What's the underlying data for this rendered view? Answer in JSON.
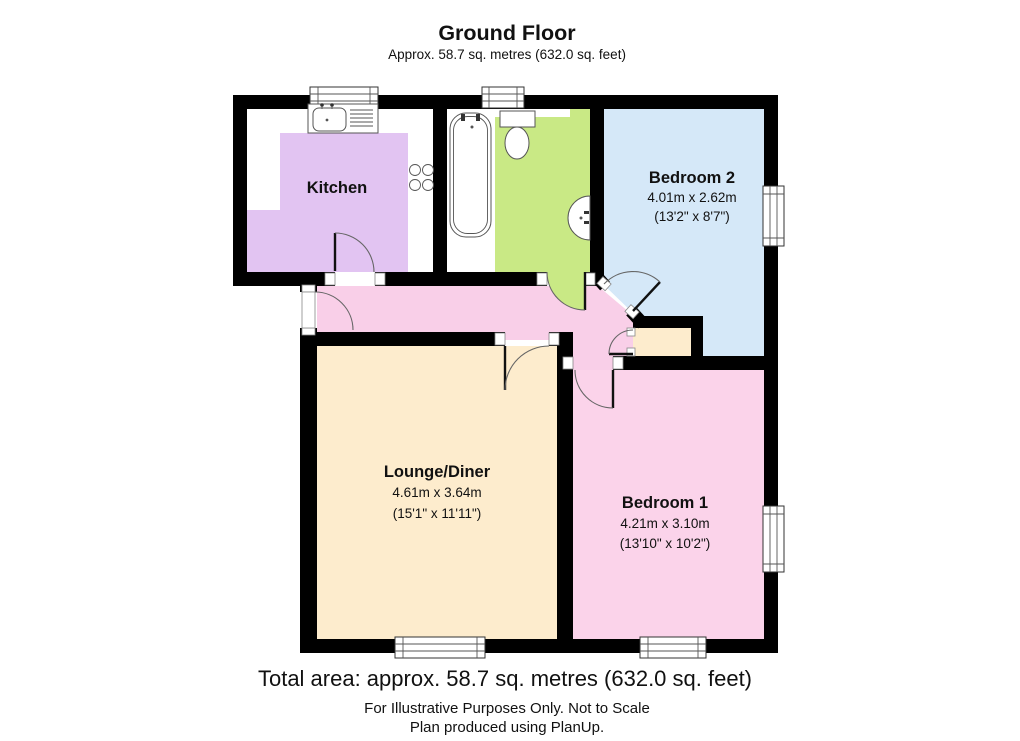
{
  "header": {
    "title": "Ground Floor",
    "subtitle": "Approx.  58.7 sq. metres (632.0 sq. feet)"
  },
  "rooms": {
    "kitchen": {
      "name": "Kitchen"
    },
    "bedroom2": {
      "name": "Bedroom 2",
      "metric": "4.01m x 2.62m",
      "imperial": "(13'2\" x 8'7\")"
    },
    "lounge": {
      "name": "Lounge/Diner",
      "metric": "4.61m x 3.64m",
      "imperial": "(15'1\" x 11'11\")"
    },
    "bedroom1": {
      "name": "Bedroom 1",
      "metric": "4.21m x 3.10m",
      "imperial": "(13'10\" x 10'2\")"
    }
  },
  "footer": {
    "total_area": "Total area: approx.  58.7 sq. metres (632.0 sq. feet)",
    "disclaimer": "For Illustrative Purposes Only. Not to Scale",
    "credit": "Plan produced using PlanUp."
  },
  "colors": {
    "kitchen": "#e2c4f2",
    "bathroom": "#c9e985",
    "bedroom2": "#d5e8f8",
    "hallway": "#f9cfe8",
    "bedroom1": "#fbd3ea",
    "lounge": "#fdeccd",
    "cupboard": "#fdeccd",
    "wall": "#000000"
  }
}
